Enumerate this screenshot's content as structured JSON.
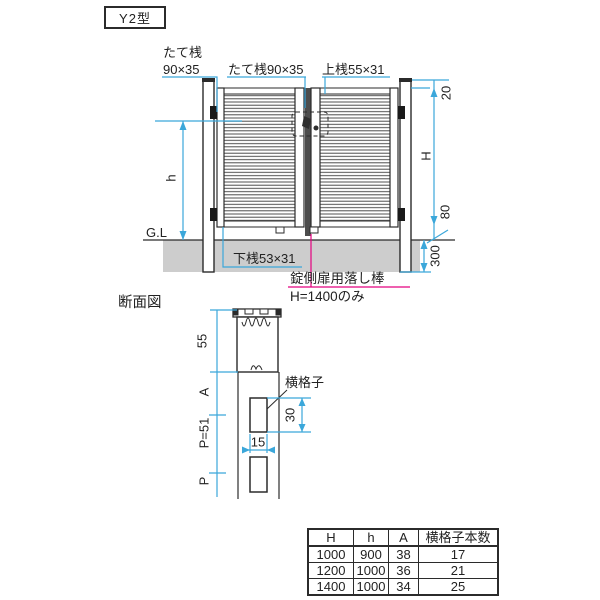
{
  "page": {
    "title_badge": "Y2型"
  },
  "elevation": {
    "labels": {
      "vertical_rail_left_line1": "たて桟",
      "vertical_rail_left_line2": "90×35",
      "vertical_rail_center": "たて桟90×35",
      "top_rail": "上桟55×31",
      "bottom_rail": "下桟53×31",
      "ground_line": "G.L"
    },
    "dimensions": {
      "top_gap": "20",
      "gate_height": "H",
      "panel_height": "h",
      "bottom_gap": "80",
      "embed_depth": "300"
    },
    "note": {
      "line1": "錠側扉用落し棒",
      "line2": "H=1400のみ"
    }
  },
  "section": {
    "title": "断面図",
    "labels": {
      "lattice": "横格子"
    },
    "dimensions": {
      "top_rail_height": "55",
      "a": "A",
      "pitch": "P=51",
      "p": "P",
      "lattice_height": "30",
      "lattice_width": "15"
    }
  },
  "table": {
    "headers": [
      "H",
      "h",
      "A",
      "横格子本数"
    ],
    "rows": [
      [
        "1000",
        "900",
        "38",
        "17"
      ],
      [
        "1200",
        "1000",
        "36",
        "21"
      ],
      [
        "1400",
        "1000",
        "34",
        "25"
      ]
    ]
  },
  "colors": {
    "dimension_line": "#3ba7da",
    "note_magenta": "#e4007f",
    "drawing_line": "#2b2b2b",
    "ground_fill": "#cdcdcd"
  }
}
